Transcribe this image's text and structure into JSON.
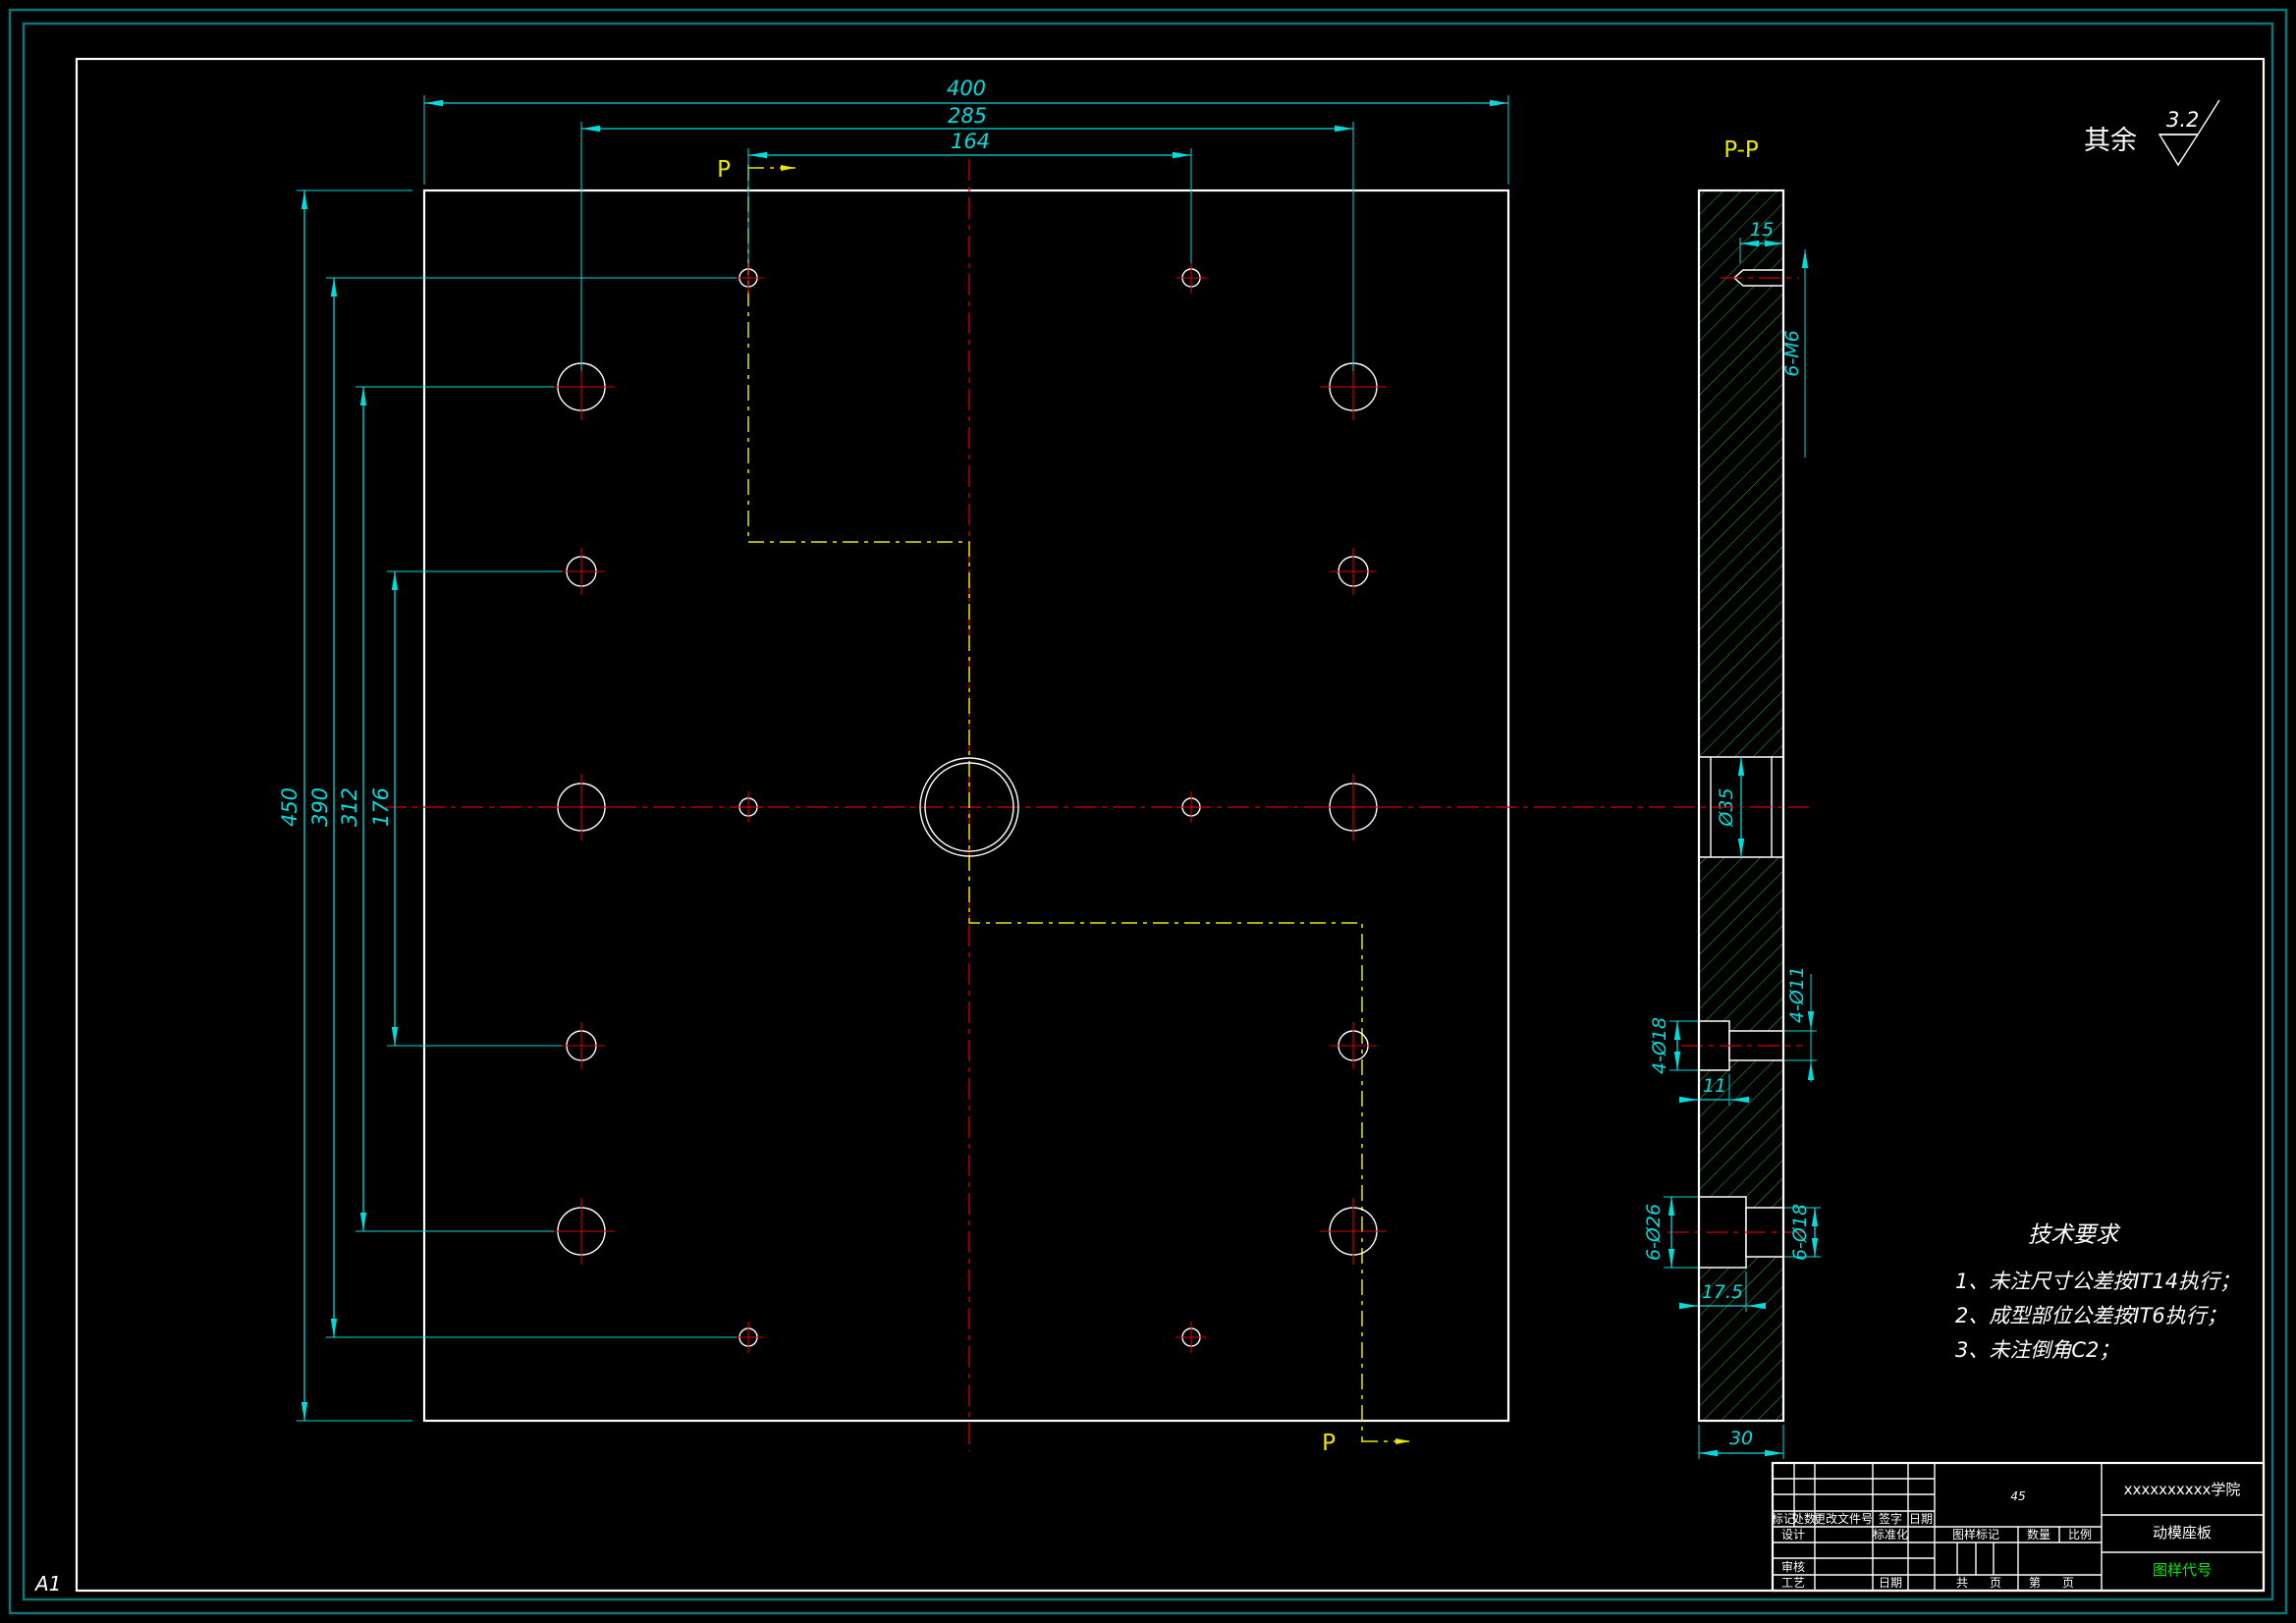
{
  "sheet": {
    "size": "A1"
  },
  "roughness": {
    "prefix": "其余",
    "value": "3.2"
  },
  "front_view": {
    "p_top": "P",
    "p_bottom": "P",
    "dims": {
      "width": "400",
      "bolt_span": "285",
      "m6_span": "164",
      "height": "450",
      "m6_height_span": "390",
      "bolt_height_span": "312",
      "mid_span": "176"
    }
  },
  "section_view": {
    "title": "P-P",
    "dims": {
      "m6_depth": "15",
      "m6_count": "6-M6",
      "center_dia": "Ø35",
      "cb18": "4-Ø18",
      "thru11": "4-Ø11",
      "cb18_depth": "11",
      "cb26": "6-Ø26",
      "thru18": "6-Ø18",
      "cb26_depth": "17.5",
      "thickness": "30"
    }
  },
  "tech_req": {
    "title": "技术要求",
    "items": [
      "1、未注尺寸公差按IT14执行；",
      "2、成型部位公差按IT6执行；",
      "3、未注倒角C2；"
    ]
  },
  "title_block": {
    "school": "xxxxxxxxxx学院",
    "part_name": "动模座板",
    "drawing_code": "图样代号",
    "material": "45",
    "labels": {
      "mark": "标记",
      "count": "处数",
      "change_doc": "更改文件号",
      "sign": "签字",
      "date": "日期",
      "design": "设计",
      "standardize": "标准化",
      "review": "审核",
      "process": "工艺",
      "date2": "日期",
      "drawing_mark": "图样标记",
      "qty": "数量",
      "scale": "比例",
      "total": "共",
      "page": "页",
      "no": "第",
      "page2": "页"
    }
  },
  "colors": {
    "dimension": "#00dcdc",
    "centerline": "#d40000",
    "hatch": "#35b035",
    "section_line": "#e8e800",
    "outline": "#ffffff",
    "drawing_code_green": "#00ee00",
    "border_teal": "#0b7575"
  }
}
